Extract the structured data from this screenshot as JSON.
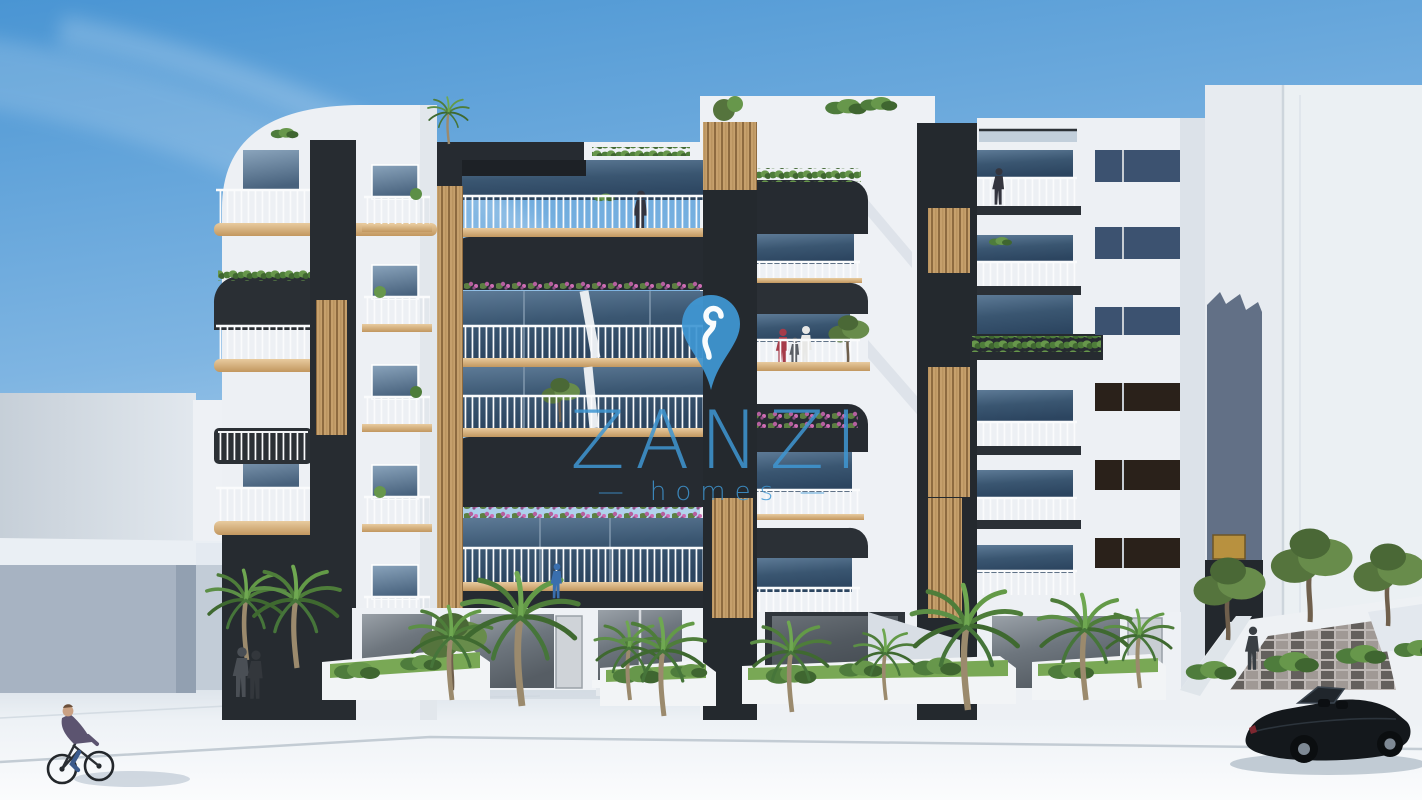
{
  "watermark": {
    "brand": "ZANZI",
    "tagline": "homes",
    "tagline_display": "— homes —",
    "pin_icon": "map-pin-icon",
    "brand_color": "#3f97d3"
  },
  "scene": {
    "type": "architectural-render",
    "subject": "modern-apartment-building-street-view",
    "palette": {
      "sky_top": "#4a95d3",
      "sky_horizon": "#e8f2f9",
      "facade_white": "#eef1f5",
      "facade_charcoal": "#262b31",
      "wood_slats": "#c6a06c",
      "balcony_glass": "#3d5671",
      "window_panel_blue": "#3c5270",
      "window_panel_brown": "#2a211a",
      "balcony_slab_tan": "#d9b585",
      "railing_white": "#fafbfc",
      "greenery": "#5c8f46",
      "street": "#f1f4f7",
      "car_black": "#14181c"
    },
    "elements": [
      "sky",
      "clouds",
      "apartment-building",
      "balconies",
      "wood-slat-panels",
      "roof-plants",
      "palm-trees",
      "planters",
      "storefronts",
      "street",
      "sidewalk",
      "cyclist",
      "convertible-car",
      "pedestrians",
      "neighbor-buildings",
      "stepped-plaza"
    ]
  }
}
